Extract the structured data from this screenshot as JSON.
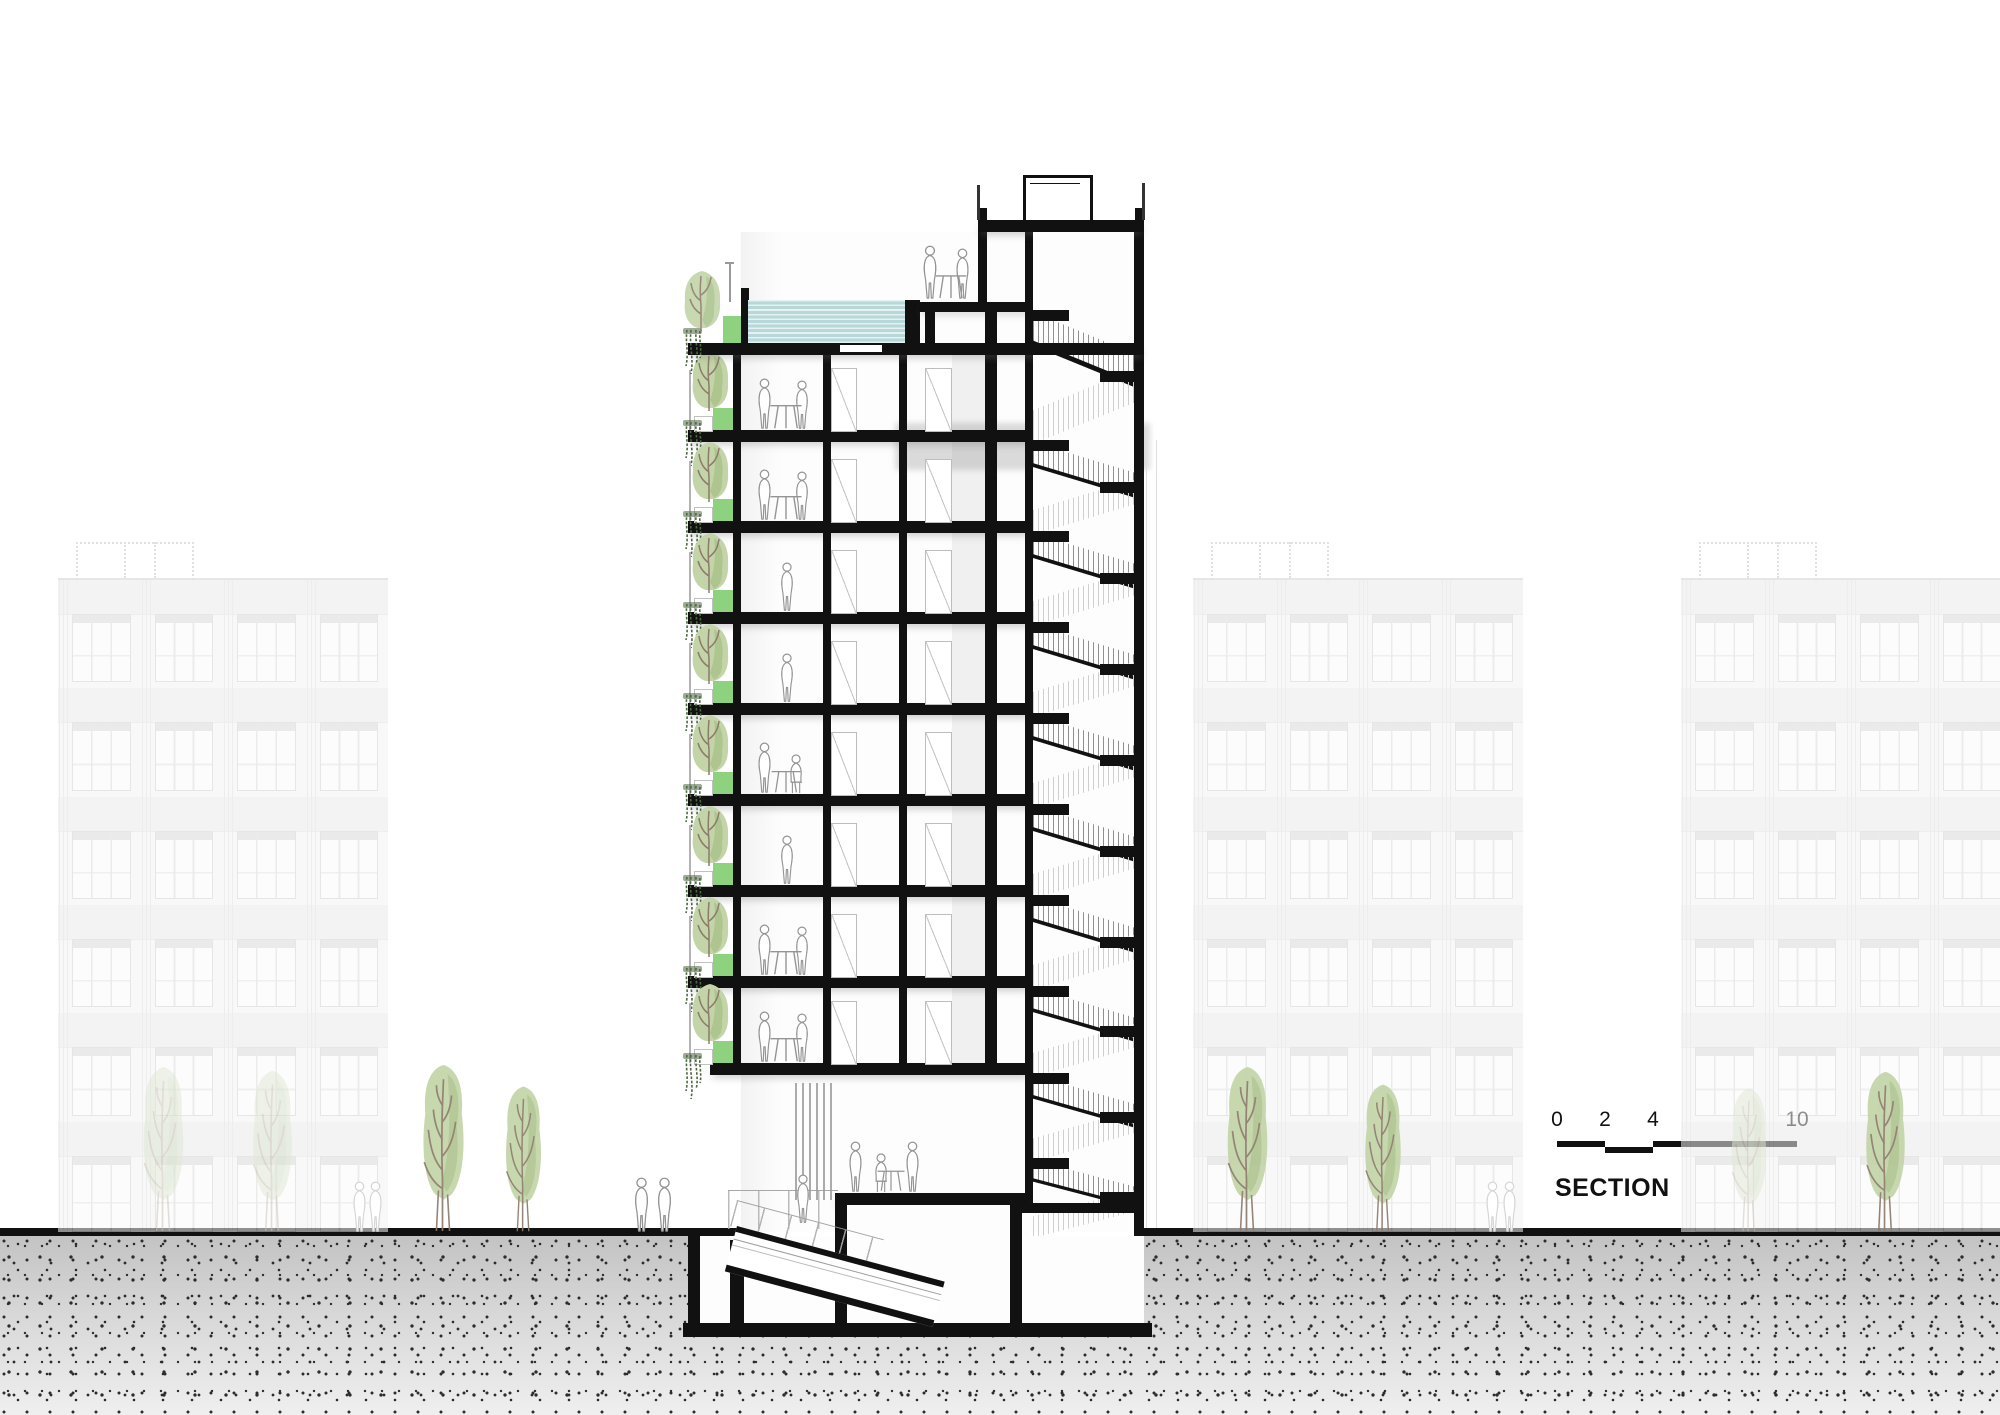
{
  "drawing_label": {
    "title": "SECTION"
  },
  "scale_bar": {
    "tick_labels": [
      "0",
      "2",
      "4",
      "10"
    ],
    "units_shown": [
      0,
      2,
      4,
      10
    ]
  },
  "palette": {
    "cut_poche": "#111111",
    "pool_water": "#b7d7d8",
    "planter_green": "#8ed17f",
    "tree_green": "#c3d4a8",
    "tree_green_dark": "#a9c089",
    "tree_green_faded": "#dfe8d5",
    "tree_green_faded_dark": "#d3dfc6",
    "vine_green": "#4d6741",
    "branch_brown": "#8d7b6c",
    "figure_line": "#949494",
    "figure_ghost": "#d6d6d6",
    "ground_gray": "#c3c3c3",
    "background_building_line": "#d9d9d9",
    "text_color": "#111111"
  },
  "tower": {
    "floor_count": 8,
    "floors": [
      {
        "level": 8,
        "occupants": "couple-at-table",
        "balcony_planting": true
      },
      {
        "level": 7,
        "occupants": "couple-at-table",
        "balcony_planting": true
      },
      {
        "level": 6,
        "occupants": "single-person",
        "balcony_planting": true
      },
      {
        "level": 5,
        "occupants": "single-person",
        "balcony_planting": true
      },
      {
        "level": 4,
        "occupants": "couple-seated",
        "balcony_planting": true
      },
      {
        "level": 3,
        "occupants": "single-person",
        "balcony_planting": true
      },
      {
        "level": 2,
        "occupants": "couple-at-table",
        "balcony_planting": true
      },
      {
        "level": 1,
        "occupants": "couple-at-table",
        "balcony_planting": true
      }
    ],
    "rooftop": {
      "pool": true,
      "deck_people": "couple-at-table",
      "pergola": true,
      "planter": true
    },
    "ground_floor": {
      "lobby_people": 3,
      "plaza_person": true,
      "ramp_to_basement": true,
      "louver_screen": true,
      "glass_balustrade": true
    },
    "basement": {
      "present": true,
      "rooms": 3
    },
    "stair_core_flights": 10
  },
  "background_buildings": [
    {
      "position": "left",
      "floors": 6,
      "window_bays": 4,
      "roof_railing": true
    },
    {
      "position": "center",
      "floors": 6,
      "window_bays": 4,
      "roof_railing": true
    },
    {
      "position": "right",
      "floors": 6,
      "window_bays": 4,
      "roof_railing": true
    }
  ],
  "street_trees": [
    {
      "x": 163,
      "h": 170,
      "style": "faded"
    },
    {
      "x": 272,
      "h": 166,
      "style": "faded"
    },
    {
      "x": 443,
      "h": 172,
      "style": "vivid"
    },
    {
      "x": 523,
      "h": 150,
      "style": "vivid"
    },
    {
      "x": 1247,
      "h": 170,
      "style": "vivid"
    },
    {
      "x": 1383,
      "h": 152,
      "style": "vivid"
    },
    {
      "x": 1749,
      "h": 148,
      "style": "faded"
    },
    {
      "x": 1885,
      "h": 165,
      "style": "vivid"
    }
  ],
  "pedestrians": [
    {
      "x": 628,
      "style": "outline"
    },
    {
      "x": 651,
      "style": "outline"
    },
    {
      "x": 347,
      "style": "ghost"
    },
    {
      "x": 363,
      "style": "ghost"
    },
    {
      "x": 1480,
      "style": "ghost"
    },
    {
      "x": 1497,
      "style": "ghost"
    }
  ]
}
